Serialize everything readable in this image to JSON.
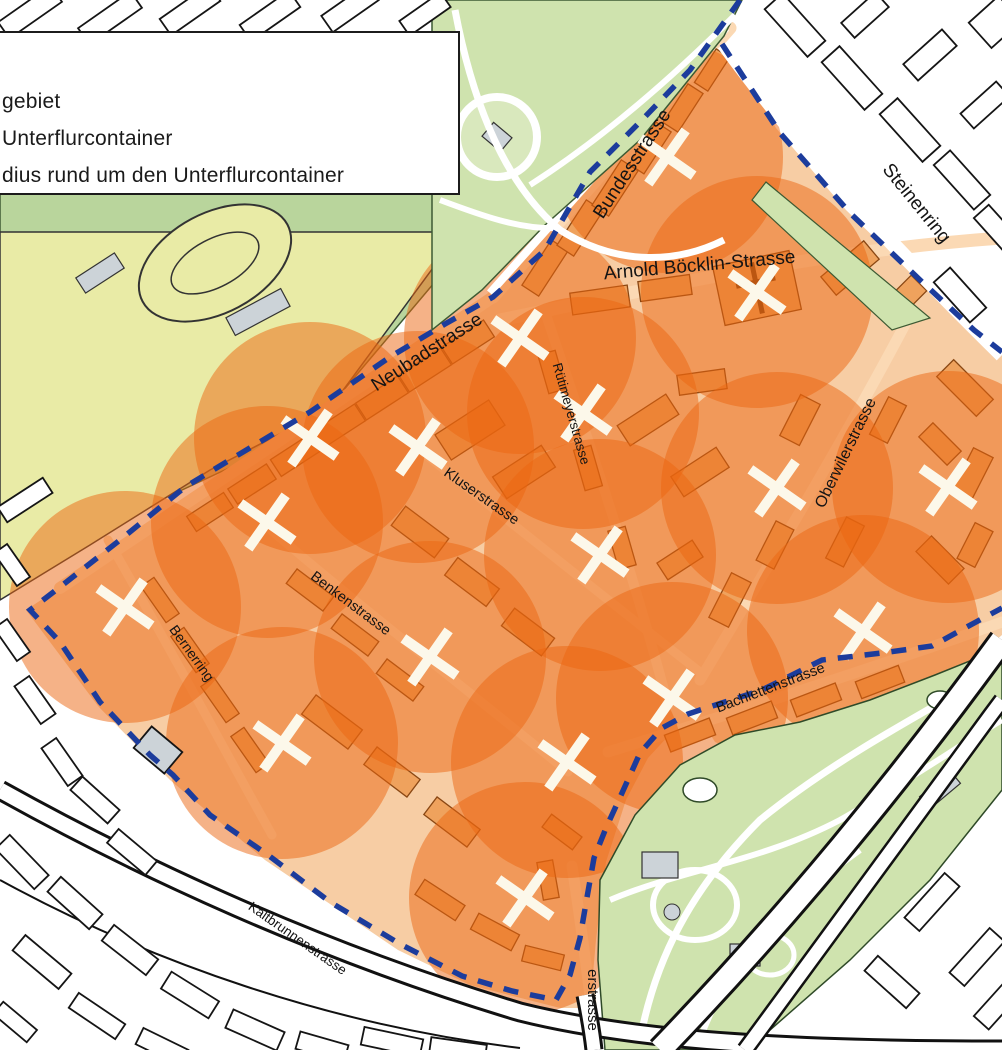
{
  "legend": {
    "items": [
      {
        "label": "gebiet"
      },
      {
        "label": "Unterflurcontainer"
      },
      {
        "label": "dius rund um den Unterflurcontainer"
      }
    ]
  },
  "map": {
    "circle_radius": 116,
    "colors": {
      "circle_fill": "rgba(235,102,16,0.5)",
      "boundary_blue": "#1c3c9c",
      "zone_base": "#f7cda4",
      "zone_street": "#fbd9b4",
      "zone_building": "#efa25d",
      "zone_building_stroke": "#8a4713",
      "park_green": "#cfe3ae",
      "park_path": "#ffffff",
      "field_yellow": "#e9eba6",
      "grey_building": "#ccd3d8",
      "outside_building_stroke": "#151515",
      "marker_white": "#fcf8ea"
    },
    "street_labels": [
      {
        "name": "Bundesstrasse",
        "x": 637,
        "y": 167,
        "rot": -57,
        "size": 19
      },
      {
        "name": "Steinenring",
        "x": 912,
        "y": 207,
        "rot": 51,
        "size": 19
      },
      {
        "name": "Arnold Böcklin-Strasse",
        "x": 700,
        "y": 271,
        "rot": -5,
        "size": 19
      },
      {
        "name": "Neubadstrasse",
        "x": 430,
        "y": 357,
        "rot": -33,
        "size": 19
      },
      {
        "name": "Rütimeyerstrasse",
        "x": 567,
        "y": 415,
        "rot": 74,
        "size": 13.5
      },
      {
        "name": "Oberwilerstrasse",
        "x": 850,
        "y": 455,
        "rot": -64,
        "size": 16
      },
      {
        "name": "Kluserstrasse",
        "x": 479,
        "y": 500,
        "rot": 35,
        "size": 14.5
      },
      {
        "name": "Benkenstrasse",
        "x": 348,
        "y": 607,
        "rot": 37,
        "size": 14.5
      },
      {
        "name": "Bernerring",
        "x": 188,
        "y": 656,
        "rot": 54,
        "size": 14
      },
      {
        "name": "Bachlettenstrasse",
        "x": 772,
        "y": 692,
        "rot": -21,
        "size": 14.5
      },
      {
        "name": "Kaltbrunnenstrasse",
        "x": 295,
        "y": 942,
        "rot": 35,
        "size": 13.5
      },
      {
        "name": "erstrasse",
        "x": 588,
        "y": 1000,
        "rot": 90,
        "size": 15
      }
    ],
    "containers": [
      {
        "x": 667,
        "y": 157
      },
      {
        "x": 757,
        "y": 292
      },
      {
        "x": 520,
        "y": 338
      },
      {
        "x": 583,
        "y": 413
      },
      {
        "x": 310,
        "y": 438
      },
      {
        "x": 418,
        "y": 447
      },
      {
        "x": 267,
        "y": 522
      },
      {
        "x": 948,
        "y": 487
      },
      {
        "x": 777,
        "y": 488
      },
      {
        "x": 600,
        "y": 555
      },
      {
        "x": 125,
        "y": 607
      },
      {
        "x": 863,
        "y": 631
      },
      {
        "x": 430,
        "y": 657
      },
      {
        "x": 672,
        "y": 698
      },
      {
        "x": 282,
        "y": 743
      },
      {
        "x": 567,
        "y": 762
      },
      {
        "x": 525,
        "y": 898
      }
    ]
  }
}
